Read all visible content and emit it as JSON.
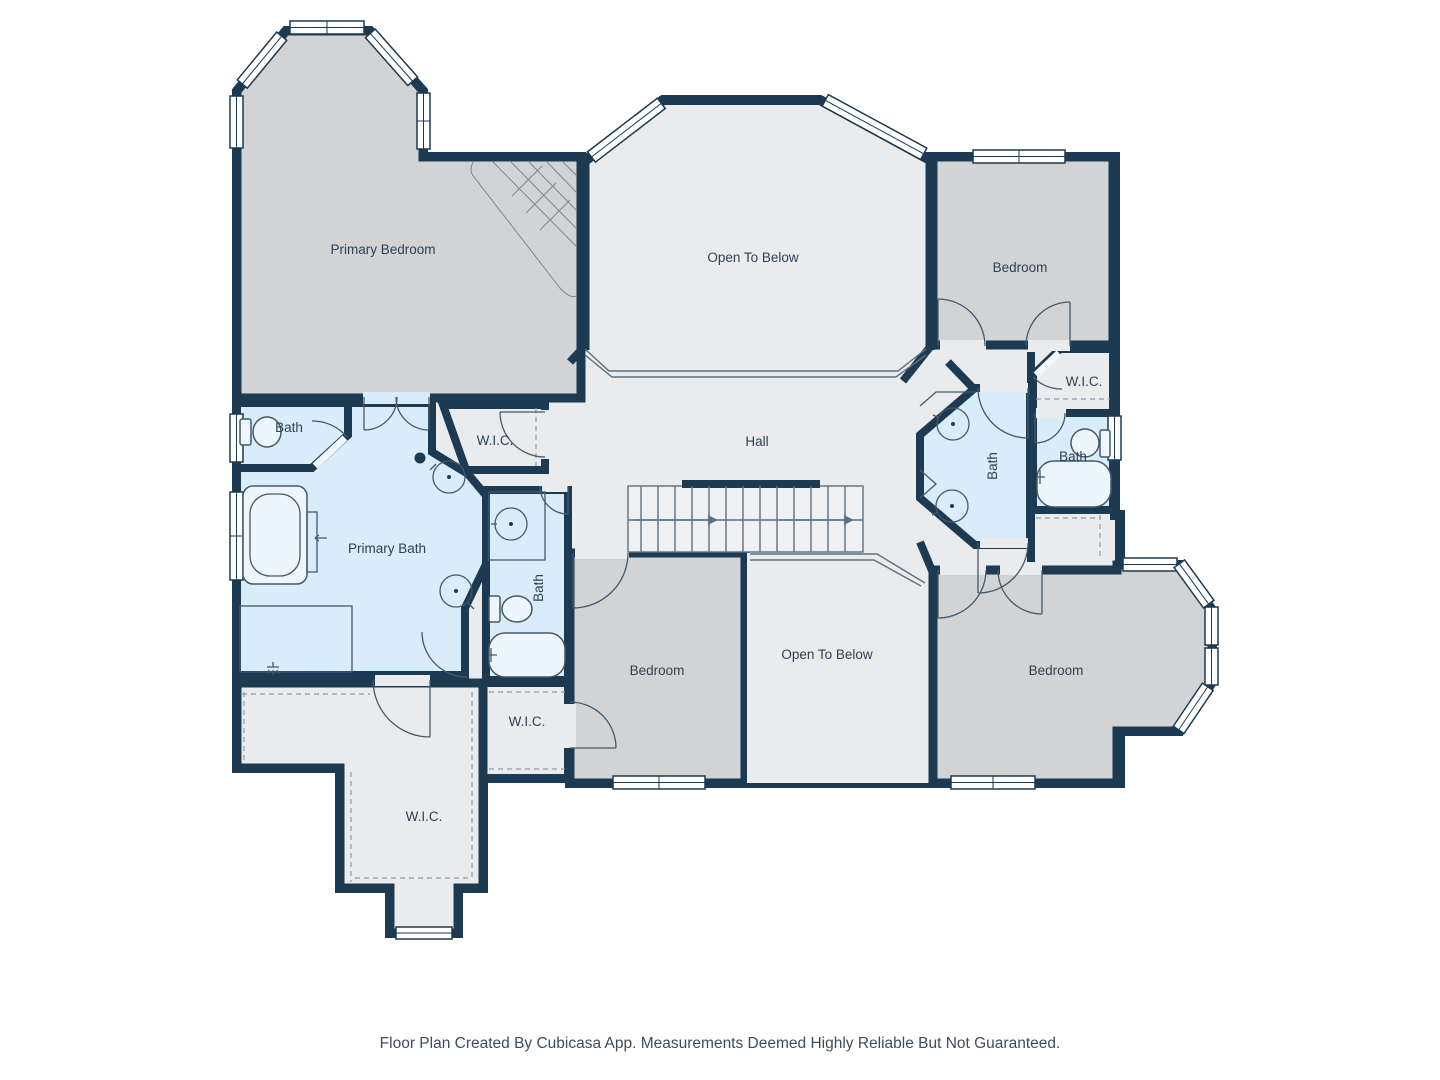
{
  "labels": {
    "primary_bedroom": "Primary Bedroom",
    "open_to_below_top": "Open To Below",
    "bedroom_top_right": "Bedroom",
    "wic_top_right": "W.I.C.",
    "bath_jack_and_jill": "Bath",
    "bath_right": "Bath",
    "hall": "Hall",
    "bath_top_left": "Bath",
    "primary_bath": "Primary Bath",
    "wic_middle": "W.I.C.",
    "bath_center": "Bath",
    "bedroom_bottom_center": "Bedroom",
    "open_to_below_bottom": "Open To Below",
    "bedroom_bottom_right": "Bedroom",
    "wic_center": "W.I.C.",
    "wic_bottom_left": "W.I.C."
  },
  "footer": {
    "text": "Floor Plan Created By Cubicasa App. Measurements Deemed Highly Reliable But Not Guaranteed."
  },
  "colors": {
    "wall": "#1c3a52",
    "room_gray": "#d2d3d5",
    "room_light": "#e9ebed",
    "room_blue": "#d9ecf9",
    "label": "#2e4154"
  }
}
